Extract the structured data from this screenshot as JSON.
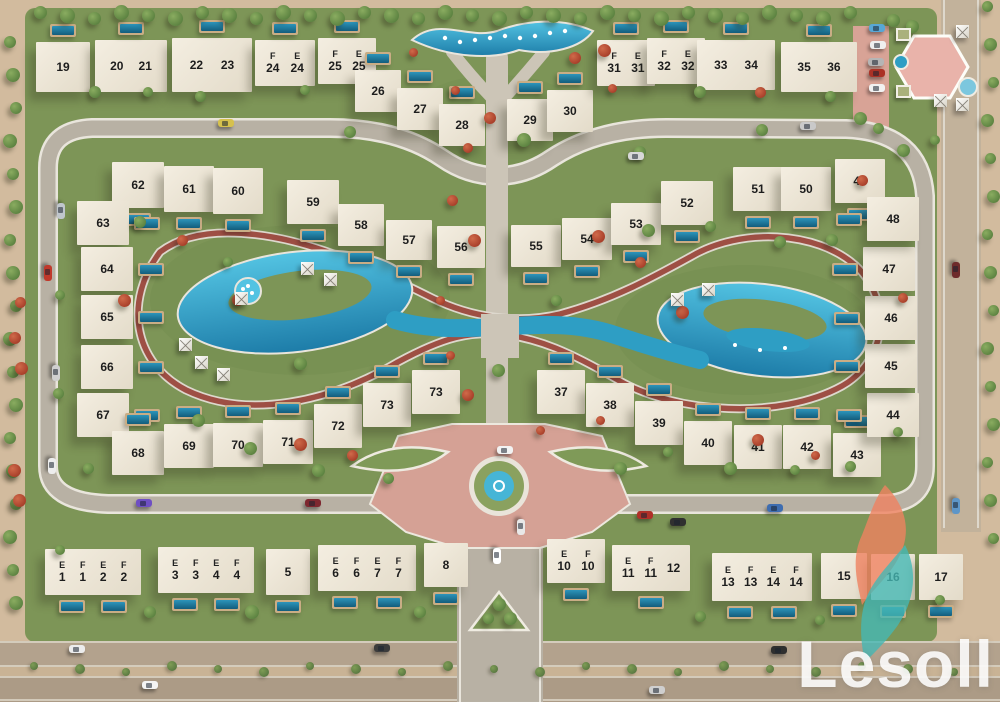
{
  "watermark": {
    "text": "Lesoll"
  },
  "palette": {
    "grass": "#7d9557",
    "sand": "#d2bb9e",
    "road": "#b8b1a4",
    "road_edge": "#e9e5dc",
    "jogging_track": "#9e4f44",
    "lagoon_light": "#53c3e2",
    "lagoon_deep": "#1d7ca8",
    "building": "#ece5d8",
    "plaza_pink": "#d5a195",
    "pavilion_pink": "#e9b3aa",
    "logo_teal": "#45b8b4",
    "logo_orange": "#ef8260",
    "label_text": "#1d1d1d"
  },
  "villas": [
    {
      "x": 36,
      "y": 42,
      "w": 54,
      "h": 50,
      "labels": [
        [
          "",
          "19"
        ]
      ],
      "pool": "n"
    },
    {
      "x": 95,
      "y": 40,
      "w": 72,
      "h": 52,
      "labels": [
        [
          "",
          "20"
        ],
        [
          "",
          "21"
        ]
      ],
      "pool": "n"
    },
    {
      "x": 172,
      "y": 38,
      "w": 80,
      "h": 54,
      "labels": [
        [
          "",
          "22"
        ],
        [
          "",
          "23"
        ]
      ],
      "pool": "n"
    },
    {
      "x": 255,
      "y": 40,
      "w": 60,
      "h": 46,
      "labels": [
        [
          "F",
          "24"
        ],
        [
          "E",
          "24"
        ]
      ],
      "pool": "n"
    },
    {
      "x": 318,
      "y": 38,
      "w": 58,
      "h": 46,
      "labels": [
        [
          "F",
          "25"
        ],
        [
          "E",
          "25"
        ]
      ],
      "pool": "n"
    },
    {
      "x": 355,
      "y": 70,
      "w": 46,
      "h": 42,
      "labels": [
        [
          "",
          "26"
        ]
      ],
      "pool": "n"
    },
    {
      "x": 397,
      "y": 88,
      "w": 46,
      "h": 42,
      "labels": [
        [
          "",
          "27"
        ]
      ],
      "pool": "n"
    },
    {
      "x": 439,
      "y": 104,
      "w": 46,
      "h": 42,
      "labels": [
        [
          "",
          "28"
        ]
      ],
      "pool": "n"
    },
    {
      "x": 507,
      "y": 99,
      "w": 46,
      "h": 42,
      "labels": [
        [
          "",
          "29"
        ]
      ],
      "pool": "n"
    },
    {
      "x": 547,
      "y": 90,
      "w": 46,
      "h": 42,
      "labels": [
        [
          "",
          "30"
        ]
      ],
      "pool": "n"
    },
    {
      "x": 597,
      "y": 40,
      "w": 58,
      "h": 46,
      "labels": [
        [
          "F",
          "31"
        ],
        [
          "E",
          "31"
        ]
      ],
      "pool": "n"
    },
    {
      "x": 647,
      "y": 38,
      "w": 58,
      "h": 46,
      "labels": [
        [
          "F",
          "32"
        ],
        [
          "E",
          "32"
        ]
      ],
      "pool": "n"
    },
    {
      "x": 697,
      "y": 40,
      "w": 78,
      "h": 50,
      "labels": [
        [
          "",
          "33"
        ],
        [
          "",
          "34"
        ]
      ],
      "pool": "n"
    },
    {
      "x": 781,
      "y": 42,
      "w": 76,
      "h": 50,
      "labels": [
        [
          "",
          "35"
        ],
        [
          "",
          "36"
        ]
      ],
      "pool": "n"
    },
    {
      "x": 112,
      "y": 162,
      "w": 52,
      "h": 46,
      "labels": [
        [
          "",
          "62"
        ]
      ],
      "pool": "s"
    },
    {
      "x": 164,
      "y": 166,
      "w": 50,
      "h": 46,
      "labels": [
        [
          "",
          "61"
        ]
      ],
      "pool": "s"
    },
    {
      "x": 213,
      "y": 168,
      "w": 50,
      "h": 46,
      "labels": [
        [
          "",
          "60"
        ]
      ],
      "pool": "s"
    },
    {
      "x": 287,
      "y": 180,
      "w": 52,
      "h": 44,
      "labels": [
        [
          "",
          "59"
        ]
      ],
      "pool": "s"
    },
    {
      "x": 338,
      "y": 204,
      "w": 46,
      "h": 42,
      "labels": [
        [
          "",
          "58"
        ]
      ],
      "pool": "s"
    },
    {
      "x": 386,
      "y": 220,
      "w": 46,
      "h": 40,
      "labels": [
        [
          "",
          "57"
        ]
      ],
      "pool": "s"
    },
    {
      "x": 437,
      "y": 226,
      "w": 48,
      "h": 42,
      "labels": [
        [
          "",
          "56"
        ]
      ],
      "pool": "s"
    },
    {
      "x": 511,
      "y": 225,
      "w": 50,
      "h": 42,
      "labels": [
        [
          "",
          "55"
        ]
      ],
      "pool": "s"
    },
    {
      "x": 562,
      "y": 218,
      "w": 50,
      "h": 42,
      "labels": [
        [
          "",
          "54"
        ]
      ],
      "pool": "s"
    },
    {
      "x": 611,
      "y": 203,
      "w": 50,
      "h": 42,
      "labels": [
        [
          "",
          "53"
        ]
      ],
      "pool": "s"
    },
    {
      "x": 661,
      "y": 181,
      "w": 52,
      "h": 44,
      "labels": [
        [
          "",
          "52"
        ]
      ],
      "pool": "s"
    },
    {
      "x": 733,
      "y": 167,
      "w": 50,
      "h": 44,
      "labels": [
        [
          "",
          "51"
        ]
      ],
      "pool": "s"
    },
    {
      "x": 781,
      "y": 167,
      "w": 50,
      "h": 44,
      "labels": [
        [
          "",
          "50"
        ]
      ],
      "pool": "s"
    },
    {
      "x": 835,
      "y": 159,
      "w": 50,
      "h": 44,
      "labels": [
        [
          "",
          "49"
        ]
      ],
      "pool": "s"
    },
    {
      "x": 77,
      "y": 201,
      "w": 52,
      "h": 44,
      "labels": [
        [
          "",
          "63"
        ]
      ],
      "pool": "e"
    },
    {
      "x": 81,
      "y": 247,
      "w": 52,
      "h": 44,
      "labels": [
        [
          "",
          "64"
        ]
      ],
      "pool": "e"
    },
    {
      "x": 81,
      "y": 295,
      "w": 52,
      "h": 44,
      "labels": [
        [
          "",
          "65"
        ]
      ],
      "pool": "e"
    },
    {
      "x": 81,
      "y": 345,
      "w": 52,
      "h": 44,
      "labels": [
        [
          "",
          "66"
        ]
      ],
      "pool": "e"
    },
    {
      "x": 77,
      "y": 393,
      "w": 52,
      "h": 44,
      "labels": [
        [
          "",
          "67"
        ]
      ],
      "pool": "e"
    },
    {
      "x": 112,
      "y": 431,
      "w": 52,
      "h": 44,
      "labels": [
        [
          "",
          "68"
        ]
      ],
      "pool": "n"
    },
    {
      "x": 164,
      "y": 424,
      "w": 50,
      "h": 44,
      "labels": [
        [
          "",
          "69"
        ]
      ],
      "pool": "n"
    },
    {
      "x": 213,
      "y": 423,
      "w": 50,
      "h": 44,
      "labels": [
        [
          "",
          "70"
        ]
      ],
      "pool": "n"
    },
    {
      "x": 263,
      "y": 420,
      "w": 50,
      "h": 44,
      "labels": [
        [
          "",
          "71"
        ]
      ],
      "pool": "n"
    },
    {
      "x": 314,
      "y": 404,
      "w": 48,
      "h": 44,
      "labels": [
        [
          "",
          "72"
        ]
      ],
      "pool": "n"
    },
    {
      "x": 363,
      "y": 383,
      "w": 48,
      "h": 44,
      "labels": [
        [
          "",
          "73"
        ]
      ],
      "pool": "n"
    },
    {
      "x": 412,
      "y": 370,
      "w": 48,
      "h": 44,
      "labels": [
        [
          "",
          "73"
        ]
      ],
      "pool": "n"
    },
    {
      "x": 537,
      "y": 370,
      "w": 48,
      "h": 44,
      "labels": [
        [
          "",
          "37"
        ]
      ],
      "pool": "n"
    },
    {
      "x": 586,
      "y": 383,
      "w": 48,
      "h": 44,
      "labels": [
        [
          "",
          "38"
        ]
      ],
      "pool": "n"
    },
    {
      "x": 635,
      "y": 401,
      "w": 48,
      "h": 44,
      "labels": [
        [
          "",
          "39"
        ]
      ],
      "pool": "n"
    },
    {
      "x": 684,
      "y": 421,
      "w": 48,
      "h": 44,
      "labels": [
        [
          "",
          "40"
        ]
      ],
      "pool": "n"
    },
    {
      "x": 734,
      "y": 425,
      "w": 48,
      "h": 44,
      "labels": [
        [
          "",
          "41"
        ]
      ],
      "pool": "n"
    },
    {
      "x": 783,
      "y": 425,
      "w": 48,
      "h": 44,
      "labels": [
        [
          "",
          "42"
        ]
      ],
      "pool": "n"
    },
    {
      "x": 833,
      "y": 433,
      "w": 48,
      "h": 44,
      "labels": [
        [
          "",
          "43"
        ]
      ],
      "pool": "n"
    },
    {
      "x": 867,
      "y": 393,
      "w": 52,
      "h": 44,
      "labels": [
        [
          "",
          "44"
        ]
      ],
      "pool": "w"
    },
    {
      "x": 865,
      "y": 344,
      "w": 52,
      "h": 44,
      "labels": [
        [
          "",
          "45"
        ]
      ],
      "pool": "w"
    },
    {
      "x": 865,
      "y": 296,
      "w": 52,
      "h": 44,
      "labels": [
        [
          "",
          "46"
        ]
      ],
      "pool": "w"
    },
    {
      "x": 863,
      "y": 247,
      "w": 52,
      "h": 44,
      "labels": [
        [
          "",
          "47"
        ]
      ],
      "pool": "w"
    },
    {
      "x": 867,
      "y": 197,
      "w": 52,
      "h": 44,
      "labels": [
        [
          "",
          "48"
        ]
      ],
      "pool": "w"
    },
    {
      "x": 45,
      "y": 549,
      "w": 96,
      "h": 46,
      "labels": [
        [
          "E",
          "1"
        ],
        [
          "F",
          "1"
        ],
        [
          "E",
          "2"
        ],
        [
          "F",
          "2"
        ]
      ],
      "pool": "s"
    },
    {
      "x": 158,
      "y": 547,
      "w": 96,
      "h": 46,
      "labels": [
        [
          "E",
          "3"
        ],
        [
          "F",
          "3"
        ],
        [
          "E",
          "4"
        ],
        [
          "F",
          "4"
        ]
      ],
      "pool": "s"
    },
    {
      "x": 266,
      "y": 549,
      "w": 44,
      "h": 46,
      "labels": [
        [
          "",
          "5"
        ]
      ],
      "pool": "s"
    },
    {
      "x": 318,
      "y": 545,
      "w": 98,
      "h": 46,
      "labels": [
        [
          "E",
          "6"
        ],
        [
          "F",
          "6"
        ],
        [
          "E",
          "7"
        ],
        [
          "F",
          "7"
        ]
      ],
      "pool": "s"
    },
    {
      "x": 424,
      "y": 543,
      "w": 44,
      "h": 44,
      "labels": [
        [
          "",
          "8"
        ]
      ],
      "pool": "s"
    },
    {
      "x": 547,
      "y": 539,
      "w": 58,
      "h": 44,
      "labels": [
        [
          "E",
          "10"
        ],
        [
          "F",
          "10"
        ]
      ],
      "pool": "s"
    },
    {
      "x": 612,
      "y": 545,
      "w": 78,
      "h": 46,
      "labels": [
        [
          "E",
          "11"
        ],
        [
          "F",
          "11"
        ],
        [
          "",
          "12"
        ]
      ],
      "pool": "s"
    },
    {
      "x": 712,
      "y": 553,
      "w": 100,
      "h": 48,
      "labels": [
        [
          "E",
          "13"
        ],
        [
          "F",
          "13"
        ],
        [
          "E",
          "14"
        ],
        [
          "F",
          "14"
        ]
      ],
      "pool": "s"
    },
    {
      "x": 821,
      "y": 553,
      "w": 46,
      "h": 46,
      "labels": [
        [
          "",
          "15"
        ]
      ],
      "pool": "s"
    },
    {
      "x": 871,
      "y": 554,
      "w": 44,
      "h": 46,
      "labels": [
        [
          "",
          "16"
        ]
      ],
      "pool": "s"
    },
    {
      "x": 919,
      "y": 554,
      "w": 44,
      "h": 46,
      "labels": [
        [
          "",
          "17"
        ]
      ],
      "pool": "s"
    }
  ],
  "umbrellas": [
    [
      308,
      269
    ],
    [
      331,
      280
    ],
    [
      242,
      299
    ],
    [
      186,
      345
    ],
    [
      202,
      363
    ],
    [
      224,
      375
    ],
    [
      709,
      290
    ],
    [
      678,
      300
    ],
    [
      963,
      32
    ],
    [
      941,
      101
    ],
    [
      963,
      105
    ]
  ],
  "cabanas": [
    [
      896,
      28
    ],
    [
      896,
      85
    ]
  ],
  "cars": [
    [
      218,
      119,
      "#d6c14d",
      "h"
    ],
    [
      628,
      152,
      "#d8d8d8",
      "h"
    ],
    [
      800,
      122,
      "#c9c9c9",
      "h"
    ],
    [
      53,
      207,
      "#c0c6cc",
      "v"
    ],
    [
      40,
      269,
      "#c0392b",
      "v"
    ],
    [
      48,
      369,
      "#cfcfcf",
      "v"
    ],
    [
      44,
      462,
      "#ededed",
      "v"
    ],
    [
      136,
      499,
      "#6f4fc3",
      "h"
    ],
    [
      305,
      499,
      "#7e2730",
      "h"
    ],
    [
      637,
      511,
      "#b03028",
      "h"
    ],
    [
      767,
      504,
      "#3e6db0",
      "h"
    ],
    [
      670,
      518,
      "#303030",
      "h"
    ],
    [
      948,
      266,
      "#6e2b2b",
      "v"
    ],
    [
      948,
      502,
      "#5e96c8",
      "v"
    ],
    [
      497,
      446,
      "#f2f2f2",
      "h"
    ],
    [
      513,
      523,
      "#e8e8e8",
      "v"
    ],
    [
      489,
      552,
      "#ffffff",
      "v"
    ],
    [
      869,
      24,
      "#57a7d6",
      "h"
    ],
    [
      870,
      41,
      "#efefef",
      "h"
    ],
    [
      868,
      58,
      "#b5b5b5",
      "h"
    ],
    [
      869,
      69,
      "#ab3226",
      "h"
    ],
    [
      869,
      84,
      "#f2f2f2",
      "h"
    ],
    [
      69,
      645,
      "#ececec",
      "h"
    ],
    [
      142,
      681,
      "#f4f4f4",
      "h"
    ],
    [
      374,
      644,
      "#3c3c3c",
      "h"
    ],
    [
      771,
      646,
      "#2f2f2f",
      "h"
    ],
    [
      649,
      686,
      "#cfcfcf",
      "h"
    ]
  ],
  "trees": {
    "rows": [
      {
        "x0": 40,
        "x1": 852,
        "y": 15,
        "step": 27,
        "s": 13,
        "t": "g"
      },
      {
        "x": 13,
        "y0": 42,
        "y1": 630,
        "step": 33,
        "s": 12,
        "t": "g"
      },
      {
        "x": 990,
        "y0": 6,
        "y1": 556,
        "step": 38,
        "s": 11,
        "t": "g"
      },
      {
        "x0": 34,
        "x1": 966,
        "y": 669,
        "step": 46,
        "s": 8,
        "t": "shrub"
      }
    ],
    "green": [
      [
        95,
        92
      ],
      [
        148,
        92
      ],
      [
        200,
        96
      ],
      [
        305,
        90
      ],
      [
        350,
        132
      ],
      [
        524,
        140
      ],
      [
        640,
        152
      ],
      [
        700,
        92
      ],
      [
        762,
        130
      ],
      [
        830,
        96
      ],
      [
        878,
        128
      ],
      [
        140,
        222
      ],
      [
        228,
        262
      ],
      [
        60,
        295
      ],
      [
        58,
        393
      ],
      [
        88,
        468
      ],
      [
        198,
        420
      ],
      [
        250,
        448
      ],
      [
        318,
        470
      ],
      [
        388,
        478
      ],
      [
        620,
        468
      ],
      [
        668,
        452
      ],
      [
        730,
        468
      ],
      [
        795,
        470
      ],
      [
        850,
        466
      ],
      [
        898,
        432
      ],
      [
        903,
        150
      ],
      [
        300,
        363
      ],
      [
        498,
        370
      ],
      [
        556,
        300
      ],
      [
        648,
        230
      ],
      [
        710,
        226
      ],
      [
        780,
        242
      ],
      [
        832,
        240
      ],
      [
        150,
        612
      ],
      [
        252,
        612
      ],
      [
        420,
        612
      ],
      [
        700,
        616
      ],
      [
        820,
        620
      ],
      [
        499,
        604
      ],
      [
        488,
        618
      ],
      [
        510,
        618
      ],
      [
        893,
        20
      ],
      [
        912,
        26
      ],
      [
        860,
        118
      ],
      [
        935,
        140
      ],
      [
        60,
        550
      ],
      [
        940,
        600
      ]
    ],
    "red": [
      [
        455,
        90
      ],
      [
        490,
        118
      ],
      [
        468,
        148
      ],
      [
        452,
        200
      ],
      [
        474,
        240
      ],
      [
        440,
        300
      ],
      [
        450,
        355
      ],
      [
        468,
        395
      ],
      [
        575,
        58
      ],
      [
        612,
        88
      ],
      [
        598,
        236
      ],
      [
        640,
        262
      ],
      [
        682,
        312
      ],
      [
        760,
        92
      ],
      [
        862,
        180
      ],
      [
        903,
        298
      ],
      [
        758,
        440
      ],
      [
        815,
        455
      ],
      [
        600,
        420
      ],
      [
        540,
        430
      ],
      [
        352,
        455
      ],
      [
        300,
        444
      ],
      [
        238,
        300
      ],
      [
        182,
        240
      ],
      [
        124,
        300
      ],
      [
        413,
        52
      ],
      [
        604,
        50
      ],
      [
        20,
        302
      ],
      [
        15,
        338
      ],
      [
        21,
        368
      ],
      [
        14,
        470
      ],
      [
        19,
        500
      ]
    ]
  }
}
